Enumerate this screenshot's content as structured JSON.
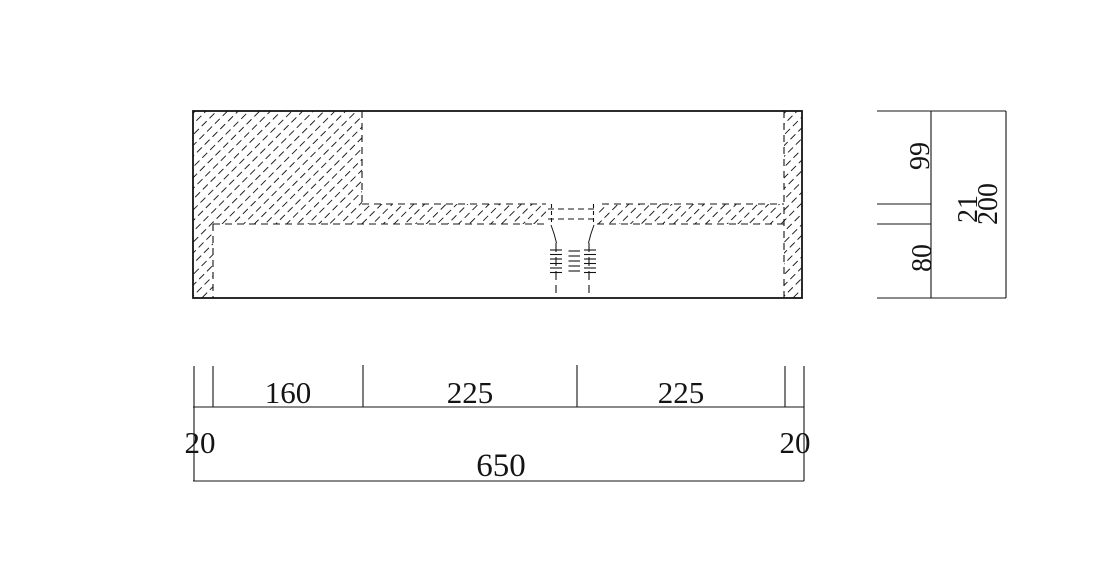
{
  "canvas": {
    "background": "#ffffff",
    "line_color": "#141414"
  },
  "dimensions": {
    "bottom": {
      "edge_left": "20",
      "segment_1": "160",
      "segment_2": "225",
      "segment_3": "225",
      "edge_right": "20",
      "overall": "650"
    },
    "right": {
      "segment_top": "99",
      "segment_middle": "21",
      "segment_bottom": "80",
      "overall": "200"
    }
  }
}
